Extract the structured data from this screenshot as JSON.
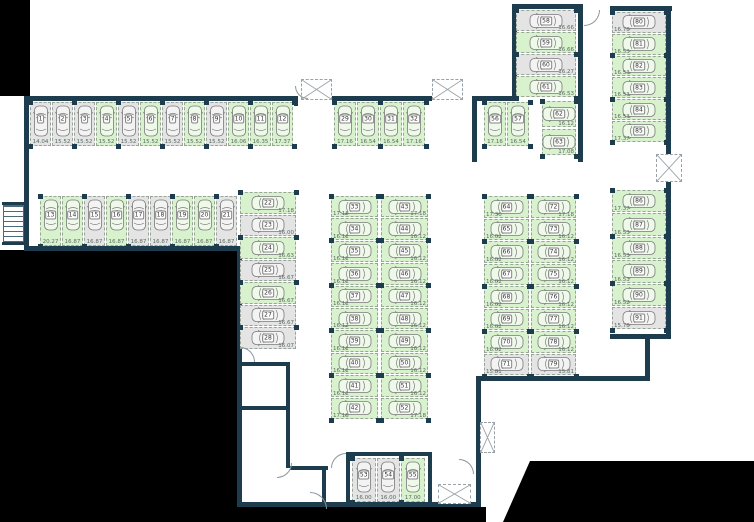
{
  "plan": {
    "name": "underground-parking-floor-plan",
    "status_colors": {
      "free": "#d9f2ce",
      "occupied": "#e4e4e4",
      "wall": "#1d3c4e"
    },
    "groups": [
      {
        "id": "row-1-12",
        "spaces": [
          {
            "num": "1",
            "area": "14.04",
            "status": "occupied"
          },
          {
            "num": "2",
            "area": "15.52",
            "status": "occupied"
          },
          {
            "num": "3",
            "area": "15.52",
            "status": "occupied"
          },
          {
            "num": "4",
            "area": "15.52",
            "status": "free"
          },
          {
            "num": "5",
            "area": "15.52",
            "status": "occupied"
          },
          {
            "num": "6",
            "area": "15.52",
            "status": "free"
          },
          {
            "num": "7",
            "area": "15.52",
            "status": "occupied"
          },
          {
            "num": "8",
            "area": "15.52",
            "status": "free"
          },
          {
            "num": "9",
            "area": "15.52",
            "status": "occupied"
          },
          {
            "num": "10",
            "area": "16.06",
            "status": "free"
          },
          {
            "num": "11",
            "area": "16.35",
            "status": "free"
          },
          {
            "num": "12",
            "area": "17.37",
            "status": "free"
          }
        ]
      },
      {
        "id": "row-13-21",
        "spaces": [
          {
            "num": "13",
            "area": "20.27",
            "status": "free"
          },
          {
            "num": "14",
            "area": "16.87",
            "status": "free"
          },
          {
            "num": "15",
            "area": "16.87",
            "status": "occupied"
          },
          {
            "num": "16",
            "area": "16.87",
            "status": "free"
          },
          {
            "num": "17",
            "area": "16.87",
            "status": "occupied"
          },
          {
            "num": "18",
            "area": "16.87",
            "status": "occupied"
          },
          {
            "num": "19",
            "area": "16.87",
            "status": "free"
          },
          {
            "num": "20",
            "area": "16.87",
            "status": "free"
          },
          {
            "num": "21",
            "area": "16.87",
            "status": "occupied"
          }
        ]
      },
      {
        "id": "col-22-28",
        "spaces": [
          {
            "num": "22",
            "area": "17.18",
            "status": "free"
          },
          {
            "num": "23",
            "area": "16.00",
            "status": "occupied"
          },
          {
            "num": "24",
            "area": "16.63",
            "status": "free"
          },
          {
            "num": "25",
            "area": "16.67",
            "status": "occupied"
          },
          {
            "num": "26",
            "area": "16.67",
            "status": "free"
          },
          {
            "num": "27",
            "area": "16.67",
            "status": "occupied"
          },
          {
            "num": "28",
            "area": "16.07",
            "status": "occupied"
          }
        ]
      },
      {
        "id": "row-29-32",
        "spaces": [
          {
            "num": "29",
            "area": "17.16",
            "status": "free"
          },
          {
            "num": "30",
            "area": "16.54",
            "status": "free"
          },
          {
            "num": "31",
            "area": "16.54",
            "status": "free"
          },
          {
            "num": "32",
            "area": "17.16",
            "status": "free"
          }
        ]
      },
      {
        "id": "col-33-42",
        "spaces": [
          {
            "num": "33",
            "area": "17.18",
            "status": "free"
          },
          {
            "num": "34",
            "area": "16.12",
            "status": "free"
          },
          {
            "num": "35",
            "area": "16.12",
            "status": "free"
          },
          {
            "num": "36",
            "area": "16.12",
            "status": "free"
          },
          {
            "num": "37",
            "area": "16.12",
            "status": "free"
          },
          {
            "num": "38",
            "area": "16.12",
            "status": "free"
          },
          {
            "num": "39",
            "area": "16.12",
            "status": "free"
          },
          {
            "num": "40",
            "area": "16.12",
            "status": "free"
          },
          {
            "num": "41",
            "area": "16.12",
            "status": "free"
          },
          {
            "num": "42",
            "area": "17.18",
            "status": "free"
          }
        ]
      },
      {
        "id": "col-43-52",
        "spaces": [
          {
            "num": "43",
            "area": "17.18",
            "status": "free"
          },
          {
            "num": "44",
            "area": "16.12",
            "status": "free"
          },
          {
            "num": "45",
            "area": "16.12",
            "status": "free"
          },
          {
            "num": "46",
            "area": "16.12",
            "status": "free"
          },
          {
            "num": "47",
            "area": "16.12",
            "status": "free"
          },
          {
            "num": "48",
            "area": "16.12",
            "status": "free"
          },
          {
            "num": "49",
            "area": "16.12",
            "status": "free"
          },
          {
            "num": "50",
            "area": "16.12",
            "status": "free"
          },
          {
            "num": "51",
            "area": "16.12",
            "status": "free"
          },
          {
            "num": "52",
            "area": "17.18",
            "status": "free"
          }
        ]
      },
      {
        "id": "row-53-55",
        "spaces": [
          {
            "num": "53",
            "area": "16.00",
            "status": "occupied"
          },
          {
            "num": "54",
            "area": "16.00",
            "status": "occupied"
          },
          {
            "num": "55",
            "area": "17.00",
            "status": "free"
          }
        ]
      },
      {
        "id": "row-56-57",
        "spaces": [
          {
            "num": "56",
            "area": "17.16",
            "status": "free"
          },
          {
            "num": "57",
            "area": "16.54",
            "status": "free"
          }
        ]
      },
      {
        "id": "col-58-61",
        "spaces": [
          {
            "num": "58",
            "area": "16.66",
            "status": "occupied"
          },
          {
            "num": "59",
            "area": "16.66",
            "status": "free"
          },
          {
            "num": "60",
            "area": "16.27",
            "status": "occupied"
          },
          {
            "num": "61",
            "area": "16.53",
            "status": "free"
          }
        ]
      },
      {
        "id": "col-62-63",
        "spaces": [
          {
            "num": "62",
            "area": "16.12",
            "status": "free"
          },
          {
            "num": "63",
            "area": "17.08",
            "status": "free"
          }
        ]
      },
      {
        "id": "col-64-71",
        "spaces": [
          {
            "num": "64",
            "area": "17.30",
            "status": "free"
          },
          {
            "num": "65",
            "area": "16.02",
            "status": "free"
          },
          {
            "num": "66",
            "area": "16.02",
            "status": "free"
          },
          {
            "num": "67",
            "area": "16.02",
            "status": "free"
          },
          {
            "num": "68",
            "area": "16.02",
            "status": "free"
          },
          {
            "num": "69",
            "area": "16.02",
            "status": "free"
          },
          {
            "num": "70",
            "area": "16.02",
            "status": "free"
          },
          {
            "num": "71",
            "area": "15.81",
            "status": "occupied"
          }
        ]
      },
      {
        "id": "col-72-79",
        "spaces": [
          {
            "num": "72",
            "area": "17.18",
            "status": "free"
          },
          {
            "num": "73",
            "area": "16.12",
            "status": "free"
          },
          {
            "num": "74",
            "area": "16.12",
            "status": "free"
          },
          {
            "num": "75",
            "area": "16.12",
            "status": "free"
          },
          {
            "num": "76",
            "area": "16.12",
            "status": "free"
          },
          {
            "num": "77",
            "area": "16.12",
            "status": "free"
          },
          {
            "num": "78",
            "area": "16.12",
            "status": "free"
          },
          {
            "num": "79",
            "area": "15.81",
            "status": "occupied"
          }
        ]
      },
      {
        "id": "col-80-85",
        "spaces": [
          {
            "num": "80",
            "area": "16.78",
            "status": "occupied"
          },
          {
            "num": "81",
            "area": "16.53",
            "status": "free"
          },
          {
            "num": "82",
            "area": "16.53",
            "status": "free"
          },
          {
            "num": "83",
            "area": "16.53",
            "status": "free"
          },
          {
            "num": "84",
            "area": "16.53",
            "status": "free"
          },
          {
            "num": "85",
            "area": "17.37",
            "status": "free"
          }
        ]
      },
      {
        "id": "col-86-91",
        "spaces": [
          {
            "num": "86",
            "area": "17.37",
            "status": "free"
          },
          {
            "num": "87",
            "area": "16.53",
            "status": "free"
          },
          {
            "num": "88",
            "area": "16.53",
            "status": "free"
          },
          {
            "num": "89",
            "area": "16.53",
            "status": "free"
          },
          {
            "num": "90",
            "area": "16.52",
            "status": "free"
          },
          {
            "num": "91",
            "area": "15.78",
            "status": "occupied"
          }
        ]
      }
    ]
  }
}
